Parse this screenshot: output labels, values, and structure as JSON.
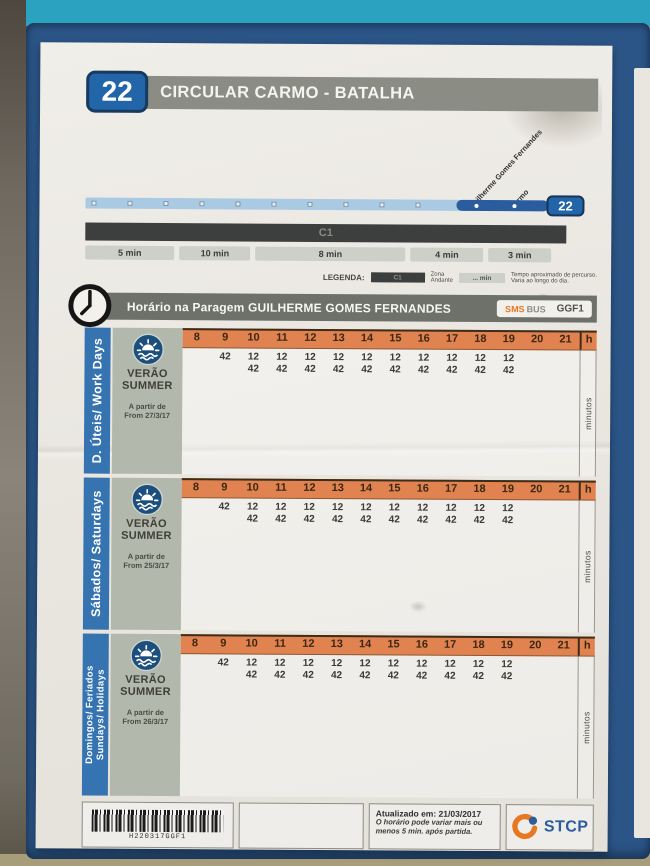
{
  "colors": {
    "route_badge_blue": "#2265a8",
    "header_gray": "#8b8d85",
    "orange_header": "#e08350",
    "day_bar_blue": "#3673b1",
    "teal_frame": "#2aa2c0",
    "navy_frame": "#2b5587",
    "stcp_orange": "#e87722",
    "stcp_blue": "#2a5d9e"
  },
  "header": {
    "route_number": "22",
    "route_name": "CIRCULAR CARMO - BATALHA"
  },
  "diagram": {
    "stop_labels": [
      "Guilherme Gomes Fernandes",
      "Carmo"
    ],
    "terminal_badge": "22",
    "zone_bar": "C1",
    "intermediate_stop_count": 10,
    "segments": [
      "5 min",
      "10 min",
      "8 min",
      "4 min",
      "3 min"
    ]
  },
  "legend": {
    "label": "LEGENDA:",
    "zone_chip": "C1",
    "zone_text_1": "Zona",
    "zone_text_2": "Andante",
    "time_chip": "... min",
    "time_text_1": "Tempo aproximado de percurso.",
    "time_text_2": "Varia ao longo do dia."
  },
  "stop_header": {
    "title": "Horário na Paragem GUILHERME GOMES FERNANDES",
    "sms_part": "SMS",
    "bus_part": "BUS",
    "stop_code": "GGF1"
  },
  "timetable": {
    "hours": [
      "8",
      "9",
      "10",
      "11",
      "12",
      "13",
      "14",
      "15",
      "16",
      "17",
      "18",
      "19",
      "20",
      "21"
    ],
    "hour_unit": "h",
    "minutes_axis_label": "minutos",
    "sections": [
      {
        "id": "workdays",
        "day_label_lines": [
          "D. Úteis/ Work Days"
        ],
        "season_line1": "VERÃO",
        "season_line2": "SUMMER",
        "valid_from_line1": "A partir de",
        "valid_from_line2": "From 27/3/17",
        "times": [
          [],
          [
            "42"
          ],
          [
            "12",
            "42"
          ],
          [
            "12",
            "42"
          ],
          [
            "12",
            "42"
          ],
          [
            "12",
            "42"
          ],
          [
            "12",
            "42"
          ],
          [
            "12",
            "42"
          ],
          [
            "12",
            "42"
          ],
          [
            "12",
            "42"
          ],
          [
            "12",
            "42"
          ],
          [
            "12",
            "42"
          ],
          [],
          []
        ]
      },
      {
        "id": "saturdays",
        "day_label_lines": [
          "Sábados/ Saturdays"
        ],
        "season_line1": "VERÃO",
        "season_line2": "SUMMER",
        "valid_from_line1": "A partir de",
        "valid_from_line2": "From 25/3/17",
        "times": [
          [],
          [
            "42"
          ],
          [
            "12",
            "42"
          ],
          [
            "12",
            "42"
          ],
          [
            "12",
            "42"
          ],
          [
            "12",
            "42"
          ],
          [
            "12",
            "42"
          ],
          [
            "12",
            "42"
          ],
          [
            "12",
            "42"
          ],
          [
            "12",
            "42"
          ],
          [
            "12",
            "42"
          ],
          [
            "12",
            "42"
          ],
          [],
          []
        ]
      },
      {
        "id": "sundays-holidays",
        "day_label_lines": [
          "Domingos/ Feriados",
          "Sundays/ Holidays"
        ],
        "season_line1": "VERÃO",
        "season_line2": "SUMMER",
        "valid_from_line1": "A partir de",
        "valid_from_line2": "From 26/3/17",
        "times": [
          [],
          [
            "42"
          ],
          [
            "12",
            "42"
          ],
          [
            "12",
            "42"
          ],
          [
            "12",
            "42"
          ],
          [
            "12",
            "42"
          ],
          [
            "12",
            "42"
          ],
          [
            "12",
            "42"
          ],
          [
            "12",
            "42"
          ],
          [
            "12",
            "42"
          ],
          [
            "12",
            "42"
          ],
          [
            "12",
            "42"
          ],
          [],
          []
        ]
      }
    ]
  },
  "footer": {
    "barcode_text": "H220317GGF1",
    "updated_line1": "Atualizado em: 21/03/2017",
    "updated_line2": "O horário pode variar mais ou",
    "updated_line3": "menos 5 min. após partida.",
    "brand": "STCP"
  }
}
